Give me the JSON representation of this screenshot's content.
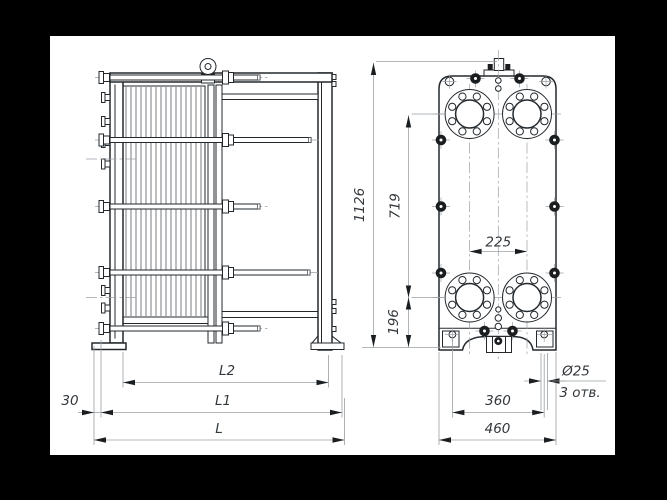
{
  "page": {
    "background": "#000000",
    "paper": "#ffffff"
  },
  "dims": {
    "overall_height": "1126",
    "port_center_span": "719",
    "foot_to_port": "196",
    "port_spacing": "225",
    "foot_hole_spacing": "360",
    "plate_width": "460",
    "hole_diameter": "Ø25",
    "hole_count_note": "3 отв.",
    "front_offset": "30",
    "pack_length": "L2",
    "frame_length": "L1",
    "overall_length": "L"
  },
  "colors": {
    "outline": "#23282c",
    "dimension_line": "#99a0a5",
    "text": "#33383c",
    "arrow": "#1b1e20"
  }
}
